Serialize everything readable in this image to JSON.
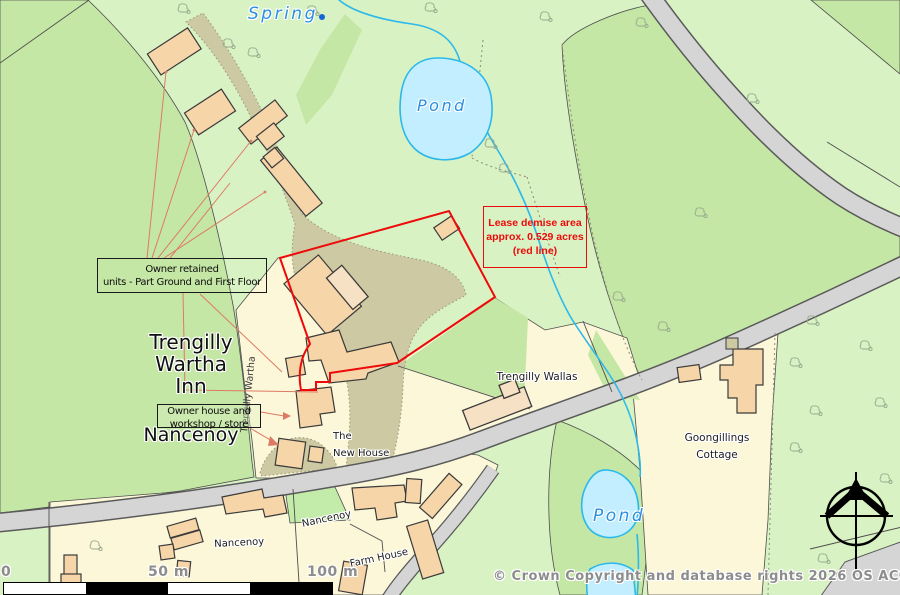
{
  "map": {
    "water": {
      "spring": "Spring",
      "pond_upper": "Pond",
      "pond_lower": "Pond"
    },
    "places": {
      "inn_lines": [
        "Trengilly",
        "Wartha",
        "Inn"
      ],
      "nancenoy_main": "Nancenoy",
      "road_name": "Trengilly Wartha",
      "new_house_lines": [
        "The",
        "New House"
      ],
      "trengilly_wallas": "Trengilly Wallas",
      "goongillings_lines": [
        "Goongillings",
        "Cottage"
      ],
      "nancenoy_hamlet_west": "Nancenoy",
      "nancenoy_hamlet_east": "Nancenoy",
      "farm_house": "Farm House"
    },
    "annotations": {
      "lease_box_lines": [
        "Lease demise area",
        "approx. 0.529 acres",
        "(red line)"
      ],
      "owner_retained_lines": [
        "Owner retained",
        "units -  Part Ground and First Floor"
      ],
      "owner_house_lines": [
        "Owner house and",
        "workshop / store"
      ]
    },
    "scale_bar": {
      "zero": "0",
      "mid": "50 m",
      "end": "100 m"
    },
    "copyright": "© Crown Copyright and database rights 2026 OS AC0000829429",
    "colors": {
      "field_light": "#d9f2c4",
      "field_medium": "#c5e7a5",
      "parcel_yellow": "#fcf7d8",
      "parcel_green": "#c3ecaa",
      "track_taupe": "#cdc9a2",
      "road_gray": "#d5d5d5",
      "road_casing": "#5a5a5a",
      "building_fill": "#f6d5a9",
      "building_light": "#f6e1c4",
      "building_stroke": "#3a3a3a",
      "water_fill": "#c3eeff",
      "water_stroke": "#2cb9ea",
      "label_blue": "#2a8fe0",
      "annotation_red": "#ee0a0a",
      "leader_red": "#dd7a64",
      "halo_gray": "#8d8d8d",
      "boundary": "#4d4d4d"
    }
  }
}
